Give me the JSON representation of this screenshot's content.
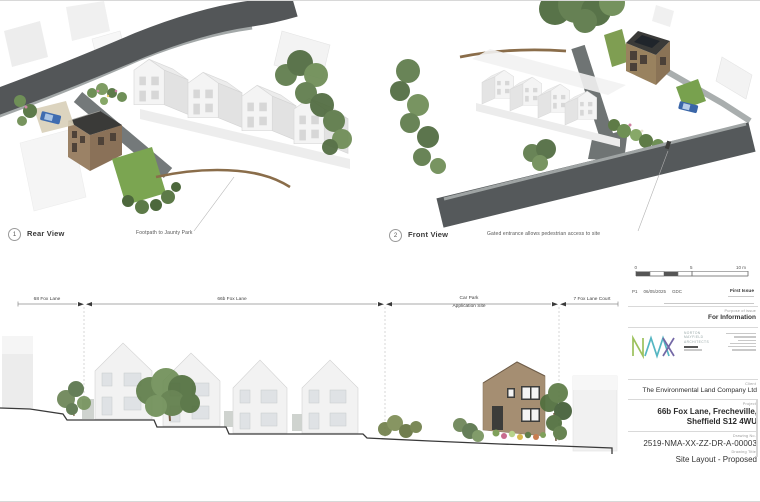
{
  "palette": {
    "road": "#535658",
    "pavement": "#a3a8a8",
    "brick": "#a58e72",
    "dark_roof": "#3a3a38",
    "tree_green": "#5d7a49",
    "lawn_green": "#7ba551",
    "car_blue": "#3f6cb0",
    "logo_green": "#9cc15c",
    "logo_teal": "#55b6c2",
    "logo_purple": "#7468a6"
  },
  "views": [
    {
      "number": "1",
      "title": "Rear View",
      "annotation": "Footpath to Jaunty Park"
    },
    {
      "number": "2",
      "title": "Front View",
      "annotation": "Gated entrance allows pedestrian access to site"
    }
  ],
  "elevation": {
    "dims": [
      {
        "label": "68 Fox Lane"
      },
      {
        "label": "66b Fox Lane"
      },
      {
        "label": "Car Park",
        "sublabel": "Application Site"
      },
      {
        "label": "7 Fox Lane Court"
      }
    ]
  },
  "titleblock": {
    "scale": {
      "zero": "0",
      "five": "5",
      "ten": "10 m"
    },
    "revision": {
      "rev": "P1",
      "date": "06/05/2025",
      "initials": "GDC",
      "description": "First Issue"
    },
    "purpose_label": "Purpose of issue",
    "purpose": "For Information",
    "firm": [
      "NORTON",
      "MAYFIELD",
      "ARCHITECTS"
    ],
    "client_label": "Client",
    "client": "The Environmental Land Company Ltd",
    "project_label": "Project",
    "project": [
      "66b Fox Lane, Frecheville,",
      "Sheffield S12 4WU"
    ],
    "drawing_no_label": "Drawing No.",
    "drawing_no": "2519-NMA-XX-ZZ-DR-A-00003",
    "drawing_title_label": "Drawing Title",
    "drawing_title": "Site Layout - Proposed"
  }
}
